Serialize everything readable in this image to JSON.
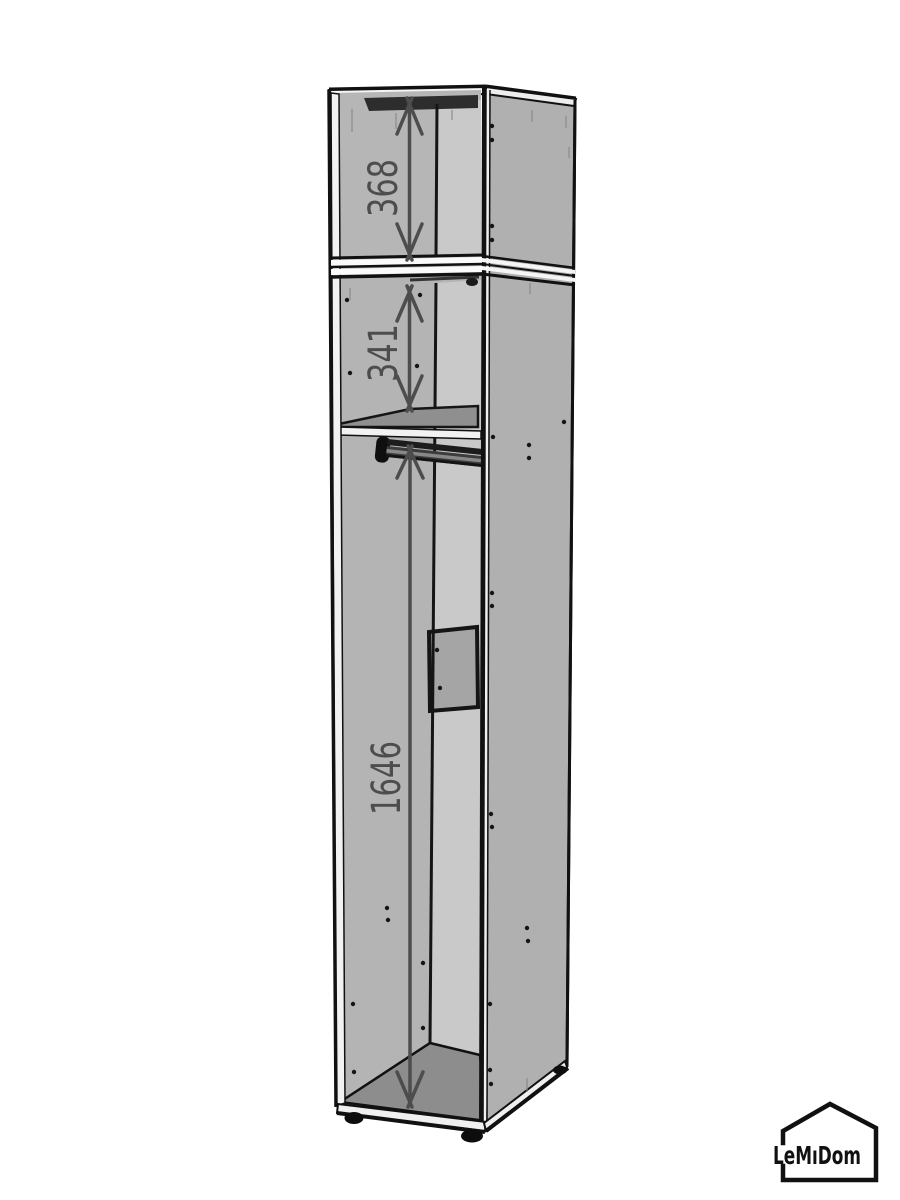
{
  "diagram": {
    "type": "furniture-dimension-drawing",
    "subject": "tall narrow wardrobe cabinet, open front, isometric view",
    "dimension_labels": {
      "top": "368",
      "middle": "341",
      "bottom": "1646"
    }
  },
  "logo": {
    "text": "LeMıDom"
  },
  "colors": {
    "background": "#ffffff",
    "side_panel": "#b0b0b0",
    "inner_left_wall": "#b4b4b4",
    "back_panel": "#c9c9c9",
    "floor": "#8d8d8d",
    "shelf_top": "#8f8f8f",
    "top_shadow_strip": "#2d2d2d",
    "outline": "#111111",
    "dimension": "#4d4d4d"
  }
}
